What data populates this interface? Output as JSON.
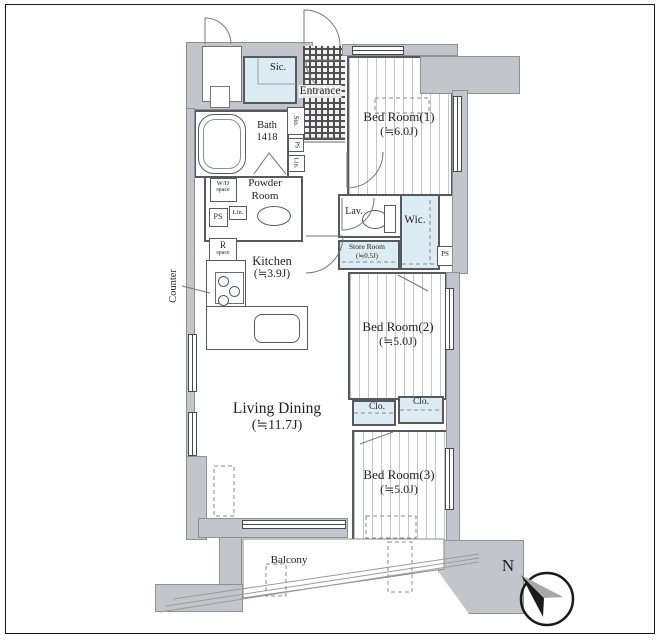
{
  "rooms": {
    "bedroom1": {
      "name": "Bed Room(1)",
      "size": "(≒6.0J)"
    },
    "bedroom2": {
      "name": "Bed Room(2)",
      "size": "(≒5.0J)"
    },
    "bedroom3": {
      "name": "Bed Room(3)",
      "size": "(≒5.0J)"
    },
    "living_dining": {
      "name": "Living Dining",
      "size": "(≒11.7J)"
    },
    "kitchen": {
      "name": "Kitchen",
      "size": "(≒3.9J)"
    },
    "bath": {
      "name": "Bath",
      "size": "1418"
    },
    "powder_room": {
      "line1": "Powder",
      "line2": "Room"
    },
    "entrance": {
      "name": "Entrance"
    },
    "balcony": {
      "name": "Balcony"
    },
    "lavatory": {
      "name": "Lav."
    },
    "walk_in_closet": {
      "name": "Wic."
    },
    "shoes_in_closet": {
      "name": "Sic."
    },
    "store_room": {
      "name": "Store Room",
      "size": "(≒0.5J)"
    },
    "closet_left": {
      "name": "Clo."
    },
    "closet_right": {
      "name": "Clo."
    }
  },
  "fixtures": {
    "storage": "Sto.",
    "pipe_space_hall": "PS",
    "pipe_space_powder": "PS",
    "pipe_space_wic": "PS",
    "linen_hall": "Lin.",
    "linen_powder": "Lin.",
    "washer_dryer": {
      "line1": "W/D",
      "line2": "space"
    },
    "refrigerator": {
      "line1": "R",
      "line2": "space"
    },
    "counter": "Counter"
  },
  "compass": {
    "north": "N"
  },
  "colors": {
    "wall_gray": "#c2c6ca",
    "closet_blue": "#dcebf4",
    "line": "#565a5e"
  }
}
